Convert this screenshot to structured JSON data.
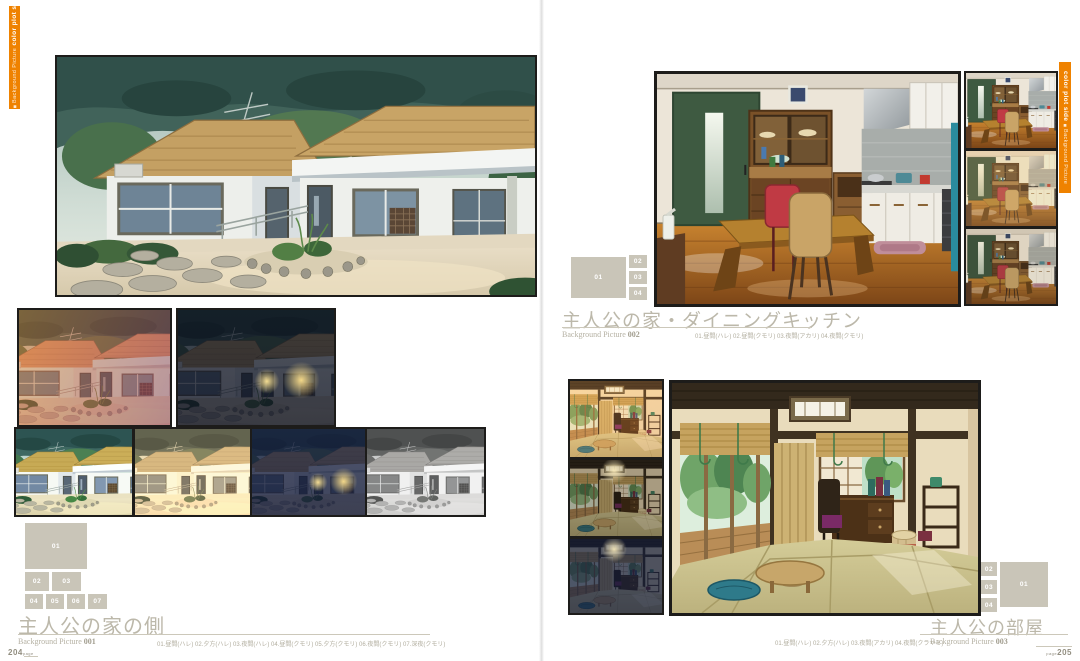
{
  "book": {
    "left_page": "204",
    "right_page": "205",
    "page_word": "page"
  },
  "tabs": {
    "bold": "color plot side",
    "small": "Background Picture",
    "marker": "■"
  },
  "colors": {
    "accent_orange": "#ef8200",
    "legend_box": "#c9c5b8",
    "title_gray": "#bcb8aa"
  },
  "sections": {
    "s1": {
      "title": "主人公の家の側",
      "label": "Background Picture ",
      "num": "001",
      "caption": "01.昼間(ハレ)  02.夕方(ハレ)  03.夜間(ハレ)  04.昼間(クモリ)  05.夕方(クモリ)  06.夜間(クモリ)  07.深夜(クモリ)",
      "legend": {
        "n1": "01",
        "n2": "02",
        "n3": "03",
        "n4": "04",
        "n5": "05",
        "n6": "06",
        "n7": "07"
      }
    },
    "s2": {
      "title": "主人公の家・ダイニングキッチン",
      "label": "Background Picture ",
      "num": "002",
      "caption": "01.昼間(ハレ)  02.昼間(クモリ)  03.夜間(アカリ)  04.夜間(クモリ)",
      "legend": {
        "n1": "01",
        "n2": "02",
        "n3": "03",
        "n4": "04"
      }
    },
    "s3": {
      "title": "主人公の部屋",
      "label": "Background Picture ",
      "num": "003",
      "caption": "01.昼間(ハレ)  02.夕方(ハレ)  03.夜間(アカリ)  04.夜間(クラヤミ)",
      "legend": {
        "n1": "01",
        "n2": "02",
        "n3": "03",
        "n4": "04"
      }
    }
  }
}
